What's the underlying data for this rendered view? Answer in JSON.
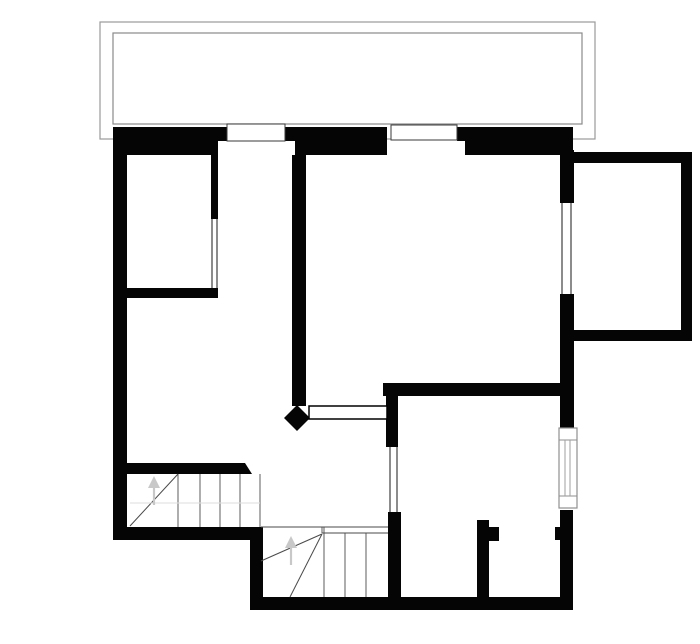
{
  "plan": {
    "description": "upper-floor architectural plan",
    "canvas": {
      "width": 700,
      "height": 644,
      "background": "#ffffff"
    },
    "colors": {
      "wall": "#050505",
      "balcony_outline": "#9a9a9a",
      "balcony_inner_outline": "#8a8a8a",
      "window_box_outline": "#3a3a3a",
      "window_frame": "#8f8f8f",
      "glazing_line": "#1a1a1a",
      "stair_tread": "#4a4a4a",
      "walk_line": "#dedede",
      "arrow": "#c8c8c8",
      "door_leaf_outline": "#000000"
    },
    "shapes": [
      {
        "name": "balcony-outer-outline",
        "type": "rect",
        "x": 100,
        "y": 22,
        "w": 495,
        "h": 117,
        "fill": "#ffffff",
        "stroke": "#9a9a9a",
        "sw": 1.2
      },
      {
        "name": "balcony-inner-outline",
        "type": "rect",
        "x": 113,
        "y": 33,
        "w": 469,
        "h": 91,
        "fill": "#ffffff",
        "stroke": "#8a8a8a",
        "sw": 1.2
      },
      {
        "name": "wall-north-upper-left",
        "type": "rect",
        "x": 113,
        "y": 127,
        "w": 114,
        "h": 14,
        "fill": "#050505"
      },
      {
        "name": "wall-north-upper-mid",
        "type": "rect",
        "x": 285,
        "y": 127,
        "w": 102,
        "h": 14,
        "fill": "#050505"
      },
      {
        "name": "wall-north-upper-right",
        "type": "rect",
        "x": 457,
        "y": 127,
        "w": 116,
        "h": 14,
        "fill": "#050505"
      },
      {
        "name": "wall-north-lower-left",
        "type": "rect",
        "x": 113,
        "y": 141,
        "w": 105,
        "h": 14,
        "fill": "#050505"
      },
      {
        "name": "wall-north-lower-mid",
        "type": "rect",
        "x": 295,
        "y": 141,
        "w": 92,
        "h": 14,
        "fill": "#050505"
      },
      {
        "name": "wall-north-lower-right",
        "type": "rect",
        "x": 465,
        "y": 141,
        "w": 108,
        "h": 14,
        "fill": "#050505"
      },
      {
        "name": "wall-west",
        "type": "rect",
        "x": 113,
        "y": 127,
        "w": 14,
        "h": 413,
        "fill": "#050505"
      },
      {
        "name": "wall-east-upper",
        "type": "rect",
        "x": 560,
        "y": 150,
        "w": 14,
        "h": 53,
        "fill": "#050505"
      },
      {
        "name": "wall-east-mid",
        "type": "rect",
        "x": 560,
        "y": 294,
        "w": 14,
        "h": 134,
        "fill": "#050505"
      },
      {
        "name": "wall-east-lower",
        "type": "rect",
        "x": 560,
        "y": 510,
        "w": 13,
        "h": 100,
        "fill": "#050505"
      },
      {
        "name": "wall-annex-top",
        "type": "rect",
        "x": 573,
        "y": 152,
        "w": 119,
        "h": 11,
        "fill": "#050505"
      },
      {
        "name": "wall-annex-right",
        "type": "rect",
        "x": 681,
        "y": 152,
        "w": 11,
        "h": 189,
        "fill": "#050505"
      },
      {
        "name": "wall-annex-bottom",
        "type": "rect",
        "x": 573,
        "y": 330,
        "w": 119,
        "h": 11,
        "fill": "#050505"
      },
      {
        "name": "wall-nw-room-east",
        "type": "rect",
        "x": 211,
        "y": 155,
        "w": 7,
        "h": 64,
        "fill": "#050505"
      },
      {
        "name": "wall-nw-room-south",
        "type": "rect",
        "x": 127,
        "y": 288,
        "w": 91,
        "h": 10,
        "fill": "#050505"
      },
      {
        "name": "wall-central",
        "type": "rect",
        "x": 292,
        "y": 155,
        "w": 14,
        "h": 251,
        "fill": "#050505"
      },
      {
        "name": "wall-se-room-top",
        "type": "rect",
        "x": 383,
        "y": 383,
        "w": 190,
        "h": 13,
        "fill": "#050505"
      },
      {
        "name": "wall-se-room-west-upper",
        "type": "rect",
        "x": 386,
        "y": 383,
        "w": 12,
        "h": 64,
        "fill": "#050505"
      },
      {
        "name": "wall-se-room-west-lower",
        "type": "rect",
        "x": 388,
        "y": 512,
        "w": 13,
        "h": 98,
        "fill": "#050505"
      },
      {
        "name": "wall-se-room-bottom",
        "type": "rect",
        "x": 388,
        "y": 597,
        "w": 185,
        "h": 13,
        "fill": "#050505"
      },
      {
        "name": "wall-closet-partition",
        "type": "rect",
        "x": 477,
        "y": 520,
        "w": 12,
        "h": 90,
        "fill": "#050505"
      },
      {
        "name": "wall-closet-door-jamb",
        "type": "rect",
        "x": 489,
        "y": 527,
        "w": 10,
        "h": 14,
        "fill": "#050505"
      },
      {
        "name": "wall-east-door-jamb",
        "type": "rect",
        "x": 555,
        "y": 527,
        "w": 7,
        "h": 13,
        "fill": "#050505"
      },
      {
        "name": "wall-stair-top",
        "type": "poly",
        "points": "127,463 245,463 252,474 127,474",
        "fill": "#050505"
      },
      {
        "name": "wall-sw-band",
        "type": "rect",
        "x": 113,
        "y": 527,
        "w": 144,
        "h": 13,
        "fill": "#050505"
      },
      {
        "name": "wall-sw-step",
        "type": "rect",
        "x": 250,
        "y": 527,
        "w": 13,
        "h": 83,
        "fill": "#050505"
      },
      {
        "name": "wall-sw-bottom",
        "type": "rect",
        "x": 250,
        "y": 597,
        "w": 140,
        "h": 13,
        "fill": "#050505"
      },
      {
        "name": "door-pivot-diamond",
        "type": "poly",
        "points": "297,405 310,418 297,431 284,418",
        "fill": "#050505"
      },
      {
        "name": "window-north-1",
        "type": "rect",
        "x": 227,
        "y": 124,
        "w": 58,
        "h": 17,
        "fill": "#ffffff",
        "stroke": "#3a3a3a",
        "sw": 1
      },
      {
        "name": "window-north-2",
        "type": "rect",
        "x": 391,
        "y": 125,
        "w": 66,
        "h": 15,
        "fill": "#ffffff",
        "stroke": "#3a3a3a",
        "sw": 1
      },
      {
        "name": "door-leaf-open",
        "type": "rect",
        "x": 309,
        "y": 406,
        "w": 78,
        "h": 13,
        "fill": "#ffffff",
        "stroke": "#000000",
        "sw": 1.5
      },
      {
        "name": "window-east-frame",
        "type": "rect",
        "x": 559,
        "y": 428,
        "w": 18,
        "h": 80,
        "fill": "#ffffff",
        "stroke": "#8f8f8f",
        "sw": 1.2
      },
      {
        "name": "window-east-frame-top",
        "type": "line",
        "x1": 559,
        "y1": 440,
        "x2": 577,
        "y2": 440,
        "stroke": "#8f8f8f",
        "sw": 1
      },
      {
        "name": "window-east-frame-bottom",
        "type": "line",
        "x1": 559,
        "y1": 496,
        "x2": 577,
        "y2": 496,
        "stroke": "#8f8f8f",
        "sw": 1
      },
      {
        "name": "window-east-glazing-1",
        "type": "line",
        "x1": 565,
        "y1": 440,
        "x2": 565,
        "y2": 496,
        "stroke": "#9f9f9f",
        "sw": 1
      },
      {
        "name": "window-east-glazing-2",
        "type": "line",
        "x1": 570,
        "y1": 440,
        "x2": 570,
        "y2": 496,
        "stroke": "#9f9f9f",
        "sw": 1
      },
      {
        "name": "glazing-nw-room-1",
        "type": "line",
        "x1": 212,
        "y1": 219,
        "x2": 212,
        "y2": 288,
        "stroke": "#1a1a1a",
        "sw": 1
      },
      {
        "name": "glazing-nw-room-2",
        "type": "line",
        "x1": 217,
        "y1": 219,
        "x2": 217,
        "y2": 288,
        "stroke": "#1a1a1a",
        "sw": 1
      },
      {
        "name": "glazing-annex-1",
        "type": "line",
        "x1": 562,
        "y1": 203,
        "x2": 562,
        "y2": 294,
        "stroke": "#1a1a1a",
        "sw": 1
      },
      {
        "name": "glazing-annex-2",
        "type": "line",
        "x1": 571,
        "y1": 203,
        "x2": 571,
        "y2": 294,
        "stroke": "#1a1a1a",
        "sw": 1
      },
      {
        "name": "glazing-hall-1",
        "type": "line",
        "x1": 390,
        "y1": 447,
        "x2": 390,
        "y2": 512,
        "stroke": "#1a1a1a",
        "sw": 1
      },
      {
        "name": "glazing-hall-2",
        "type": "line",
        "x1": 397,
        "y1": 447,
        "x2": 397,
        "y2": 512,
        "stroke": "#1a1a1a",
        "sw": 1
      },
      {
        "name": "stair1-tread-1",
        "type": "line",
        "x1": 178,
        "y1": 474,
        "x2": 178,
        "y2": 527,
        "stroke": "#4a4a4a",
        "sw": 0.9
      },
      {
        "name": "stair1-tread-2",
        "type": "line",
        "x1": 200,
        "y1": 474,
        "x2": 200,
        "y2": 527,
        "stroke": "#4a4a4a",
        "sw": 0.9
      },
      {
        "name": "stair1-tread-3",
        "type": "line",
        "x1": 220,
        "y1": 474,
        "x2": 220,
        "y2": 527,
        "stroke": "#4a4a4a",
        "sw": 0.9
      },
      {
        "name": "stair1-tread-4",
        "type": "line",
        "x1": 240,
        "y1": 474,
        "x2": 240,
        "y2": 527,
        "stroke": "#4a4a4a",
        "sw": 0.9
      },
      {
        "name": "stair1-edge",
        "type": "line",
        "x1": 260,
        "y1": 474,
        "x2": 260,
        "y2": 527,
        "stroke": "#4a4a4a",
        "sw": 0.9
      },
      {
        "name": "stair1-winder-line",
        "type": "line",
        "x1": 130,
        "y1": 526,
        "x2": 178,
        "y2": 474,
        "stroke": "#4a4a4a",
        "sw": 1
      },
      {
        "name": "stair1-walk-line",
        "type": "line",
        "x1": 130,
        "y1": 503,
        "x2": 260,
        "y2": 503,
        "stroke": "#dedede",
        "sw": 1
      },
      {
        "name": "stair1-arrow-stem",
        "type": "line",
        "x1": 154,
        "y1": 505,
        "x2": 154,
        "y2": 486,
        "stroke": "#c8c8c8",
        "sw": 2.2
      },
      {
        "name": "stair1-arrow-head",
        "type": "poly",
        "points": "148,488 160,488 154,476",
        "fill": "#c8c8c8"
      },
      {
        "name": "stair2-landing-line-a",
        "type": "line",
        "x1": 261,
        "y1": 527,
        "x2": 388,
        "y2": 527,
        "stroke": "#4a4a4a",
        "sw": 0.9
      },
      {
        "name": "stair2-landing-line-b",
        "type": "line",
        "x1": 322,
        "y1": 533,
        "x2": 388,
        "y2": 533,
        "stroke": "#4a4a4a",
        "sw": 0.9
      },
      {
        "name": "stair2-landing-step",
        "type": "line",
        "x1": 322,
        "y1": 527,
        "x2": 322,
        "y2": 533,
        "stroke": "#4a4a4a",
        "sw": 0.9
      },
      {
        "name": "stair2-tread-1",
        "type": "line",
        "x1": 324,
        "y1": 527,
        "x2": 324,
        "y2": 597,
        "stroke": "#4a4a4a",
        "sw": 0.9
      },
      {
        "name": "stair2-tread-2",
        "type": "line",
        "x1": 345,
        "y1": 533,
        "x2": 345,
        "y2": 597,
        "stroke": "#4a4a4a",
        "sw": 0.9
      },
      {
        "name": "stair2-tread-3",
        "type": "line",
        "x1": 366,
        "y1": 533,
        "x2": 366,
        "y2": 597,
        "stroke": "#4a4a4a",
        "sw": 0.9
      },
      {
        "name": "stair2-winder-line-1",
        "type": "line",
        "x1": 322,
        "y1": 534,
        "x2": 261,
        "y2": 561,
        "stroke": "#4a4a4a",
        "sw": 1
      },
      {
        "name": "stair2-winder-line-2",
        "type": "line",
        "x1": 322,
        "y1": 534,
        "x2": 290,
        "y2": 597,
        "stroke": "#4a4a4a",
        "sw": 1
      },
      {
        "name": "stair2-arrow-stem",
        "type": "line",
        "x1": 291,
        "y1": 565,
        "x2": 291,
        "y2": 546,
        "stroke": "#c8c8c8",
        "sw": 2.2
      },
      {
        "name": "stair2-arrow-head",
        "type": "poly",
        "points": "285,548 297,548 291,536",
        "fill": "#c8c8c8"
      }
    ]
  }
}
